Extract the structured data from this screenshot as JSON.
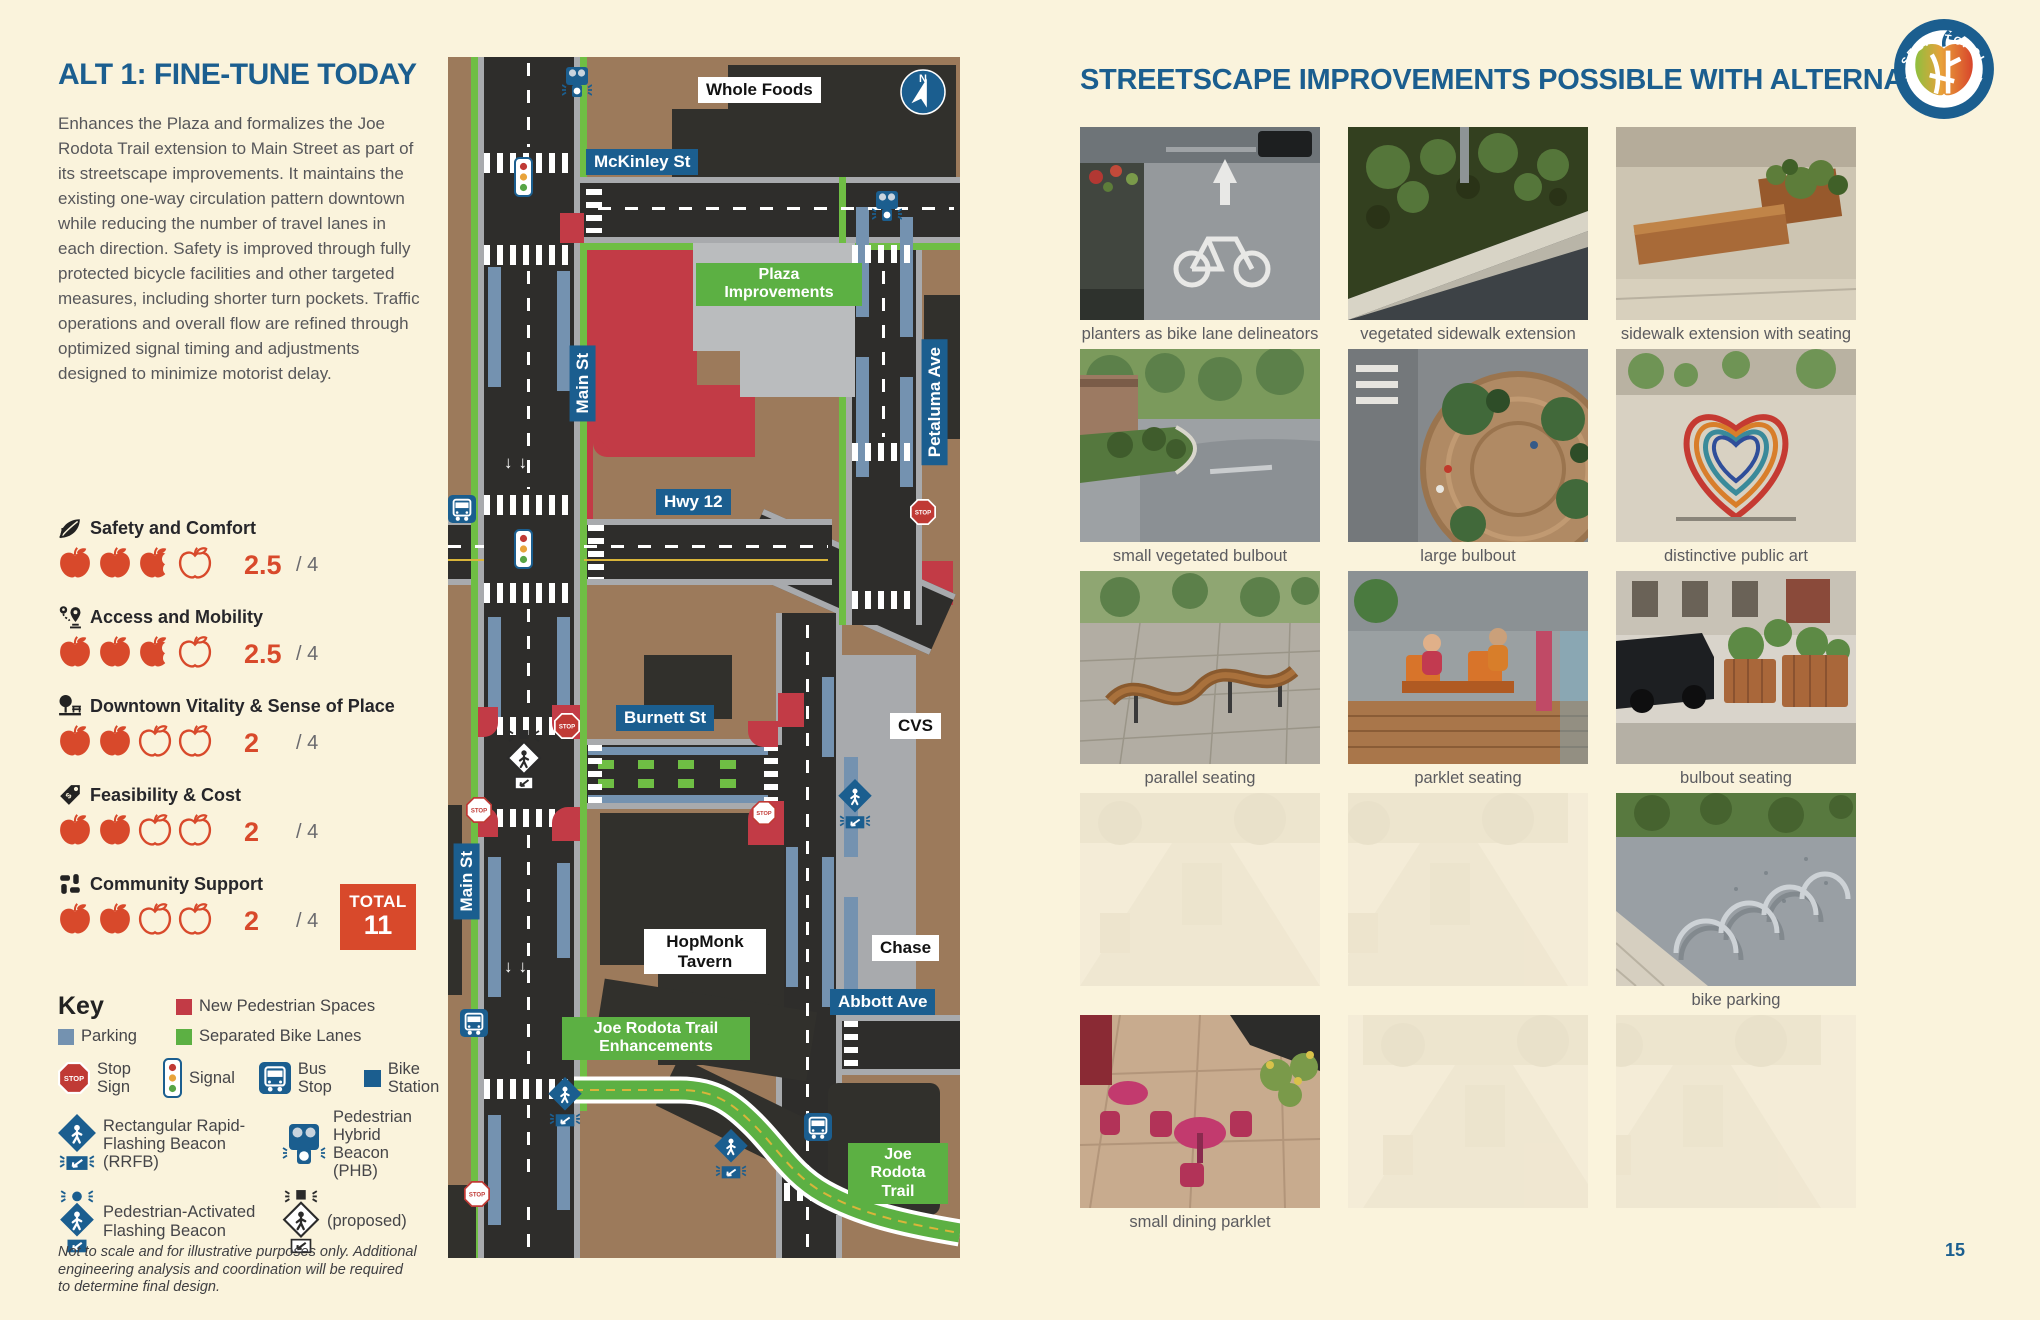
{
  "page": {
    "number": "15",
    "bg": "#FAF3DC"
  },
  "left": {
    "title": "ALT 1: FINE-TUNE TODAY",
    "description": "Enhances the Plaza and formalizes the Joe Rodota Trail extension to Main Street as part of its streetscape improvements. It maintains the existing one-way circulation pattern downtown while reducing the number of travel lanes in each direction. Safety is improved through fully protected bicycle facilities and other targeted measures, including shorter turn pockets. Traffic operations and overall flow are refined through optimized signal timing and adjustments designed to minimize motorist delay.",
    "ratings": [
      {
        "label": "Safety and Comfort",
        "icon": "leaf-icon",
        "score": "2.5",
        "of": "/ 4",
        "full": 2,
        "half": 1,
        "empty": 1
      },
      {
        "label": "Access and Mobility",
        "icon": "route-pins-icon",
        "score": "2.5",
        "of": "/ 4",
        "full": 2,
        "half": 1,
        "empty": 1
      },
      {
        "label": "Downtown Vitality & Sense of Place",
        "icon": "park-icon",
        "score": "2",
        "of": "/ 4",
        "full": 2,
        "half": 0,
        "empty": 2
      },
      {
        "label": "Feasibility & Cost",
        "icon": "price-tag-icon",
        "score": "2",
        "of": "/ 4",
        "full": 2,
        "half": 0,
        "empty": 2
      },
      {
        "label": "Community Support",
        "icon": "hands-icon",
        "score": "2",
        "of": "/ 4",
        "full": 2,
        "half": 0,
        "empty": 2
      }
    ],
    "apple_red": "#D8492B",
    "total": {
      "label": "TOTAL",
      "value": "11"
    },
    "key": {
      "title": "Key",
      "swatches": [
        {
          "label": "Parking",
          "color": "#7492B0"
        },
        {
          "label": "New Pedestrian Spaces",
          "color": "#C23B46"
        },
        {
          "label": "Separated Bike Lanes",
          "color": "#5CB043"
        }
      ],
      "icons": [
        {
          "label": "Stop Sign",
          "icon": "stop-sign-icon"
        },
        {
          "label": "Signal",
          "icon": "traffic-signal-icon"
        },
        {
          "label": "Bus Stop",
          "icon": "bus-icon"
        },
        {
          "label": "Bike Station",
          "icon": "bike-station-icon"
        },
        {
          "label": "Rectangular Rapid-Flashing Beacon (RRFB)",
          "icon": "rrfb-icon"
        },
        {
          "label": "Pedestrian Hybrid Beacon (PHB)",
          "icon": "phb-icon"
        },
        {
          "label": "Pedestrian-Activated Flashing Beacon",
          "icon": "pafb-icon"
        },
        {
          "label": "(proposed)",
          "icon": "proposed-beacon-icon"
        }
      ]
    },
    "disclaimer": "Not to scale and for illustrative purposes only. Additional engineering analysis and coordination will be required to determine final design."
  },
  "map": {
    "compass": "N",
    "labels": [
      {
        "text": "Whole Foods",
        "style": "white"
      },
      {
        "text": "McKinley St",
        "style": "blue"
      },
      {
        "text": "Main St",
        "style": "blue-vertical"
      },
      {
        "text": "Plaza Improvements",
        "style": "green"
      },
      {
        "text": "Hwy 12",
        "style": "blue"
      },
      {
        "text": "Petaluma Ave",
        "style": "blue-vertical"
      },
      {
        "text": "Burnett St",
        "style": "blue"
      },
      {
        "text": "CVS",
        "style": "white"
      },
      {
        "text": "Main St",
        "style": "blue-vertical"
      },
      {
        "text": "HopMonk Tavern",
        "style": "white"
      },
      {
        "text": "Chase",
        "style": "white"
      },
      {
        "text": "Abbott Ave",
        "style": "blue"
      },
      {
        "text": "Joe Rodota Trail Enhancements",
        "style": "green"
      },
      {
        "text": "Joe Rodota Trail",
        "style": "green"
      }
    ],
    "colors": {
      "land": "#9C7A5B",
      "road": "#2E2D2B",
      "bike_lane": "#6FBE44",
      "parking": "#7492B0",
      "pedestrian_space": "#C23B46",
      "plaza": "#BABCBE"
    }
  },
  "right": {
    "title": "STREETSCAPE IMPROVEMENTS POSSIBLE WITH ALTERNATIVE 1",
    "logo": {
      "top": "SEBASTOPOL",
      "bottom": "REIMAGINING THE CORE"
    },
    "photos": [
      {
        "caption": "planters as bike lane delineators",
        "art": "bike-lane-planters",
        "faded": false
      },
      {
        "caption": "vegetated sidewalk extension",
        "art": "vegetated-sidewalk",
        "faded": false
      },
      {
        "caption": "sidewalk extension with seating",
        "art": "sidewalk-seating",
        "faded": false
      },
      {
        "caption": "small vegetated bulbout",
        "art": "small-bulbout",
        "faded": false
      },
      {
        "caption": "large bulbout",
        "art": "large-bulbout",
        "faded": false
      },
      {
        "caption": "distinctive public art",
        "art": "public-art",
        "faded": false
      },
      {
        "caption": "parallel seating",
        "art": "parallel-seating",
        "faded": false
      },
      {
        "caption": "parklet seating",
        "art": "parklet-seating",
        "faded": false
      },
      {
        "caption": "bulbout seating",
        "art": "bulbout-seating",
        "faded": false
      },
      {
        "caption": "",
        "art": "faded-a",
        "faded": true
      },
      {
        "caption": "",
        "art": "faded-b",
        "faded": true
      },
      {
        "caption": "bike parking",
        "art": "bike-parking",
        "faded": false
      },
      {
        "caption": "small dining parklet",
        "art": "dining-parklet",
        "faded": false
      },
      {
        "caption": "",
        "art": "faded-c",
        "faded": true
      },
      {
        "caption": "",
        "art": "faded-d",
        "faded": true
      }
    ]
  }
}
